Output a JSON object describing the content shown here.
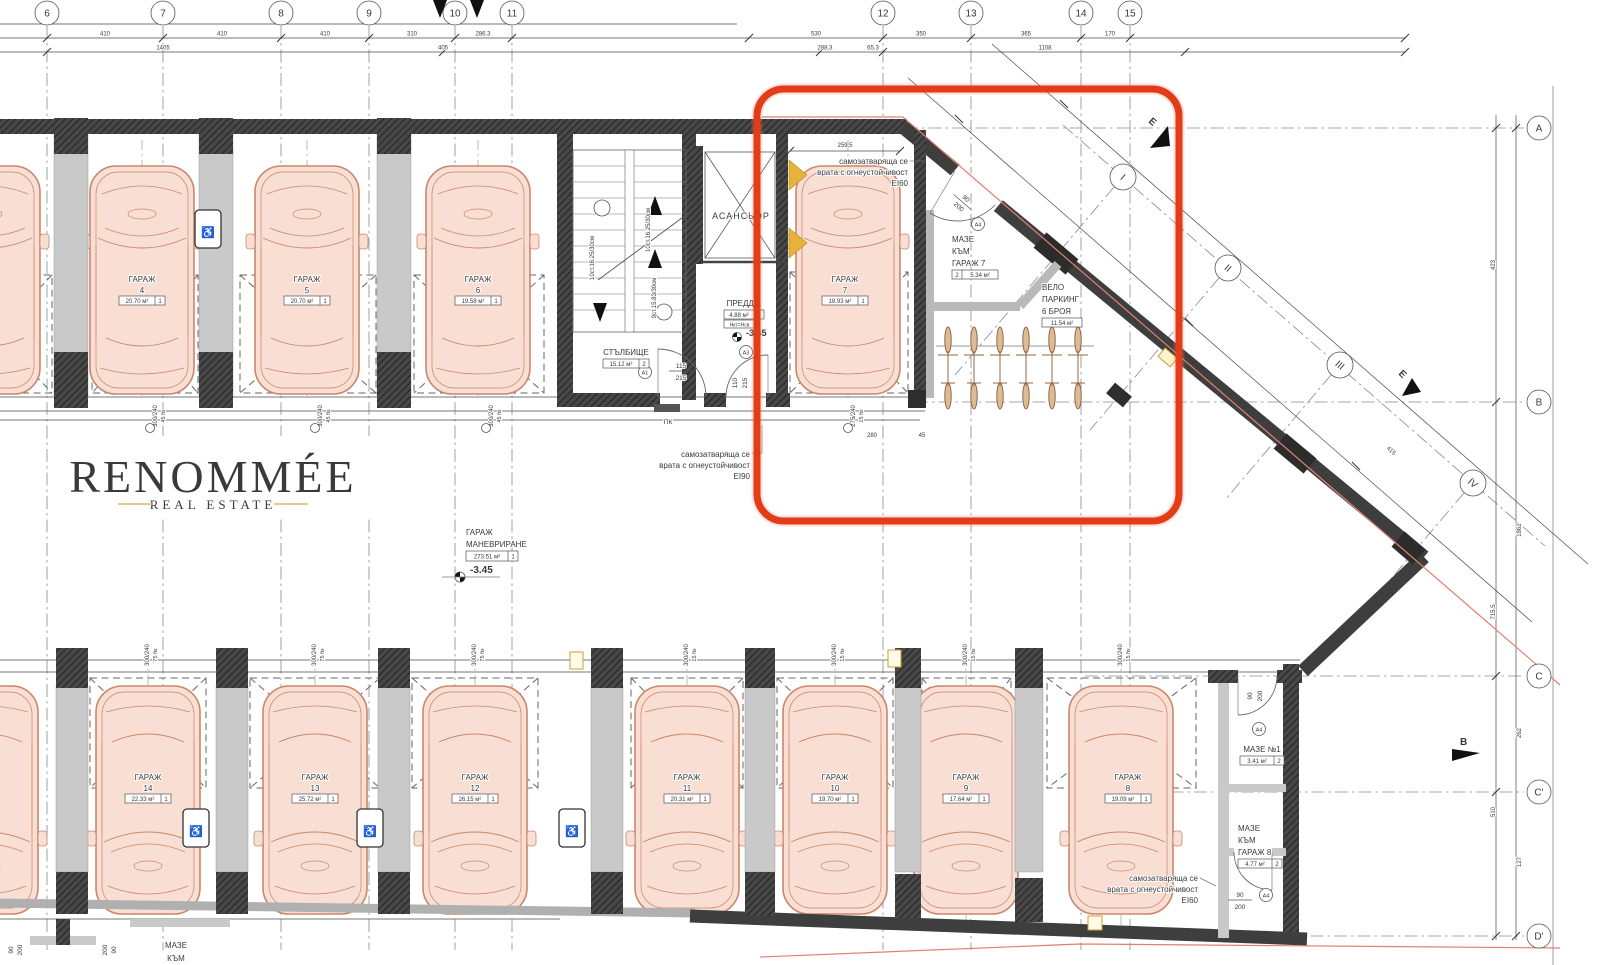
{
  "logo": {
    "title": "RENOMMÉE",
    "subtitle": "REAL ESTATE",
    "gold": "#c9a45a",
    "ink": "#262626"
  },
  "highlight": {
    "color": "#e23c18"
  },
  "grid": {
    "top": [
      "6",
      "7",
      "8",
      "9",
      "10",
      "11",
      "12",
      "13",
      "14",
      "15"
    ],
    "right": [
      "A",
      "B",
      "C",
      "C'",
      "D'"
    ],
    "diag": [
      "I",
      "II",
      "III",
      "IV"
    ],
    "axisE": "E",
    "axisB": "B"
  },
  "garages": {
    "g3": {
      "t": "ГАРАЖ",
      "n": "3",
      "a": "20.70 м²",
      "c": "1"
    },
    "g4": {
      "t": "ГАРАЖ",
      "n": "4",
      "a": "20.70 м²",
      "c": "1"
    },
    "g5": {
      "t": "ГАРАЖ",
      "n": "5",
      "a": "20.70 м²",
      "c": "1"
    },
    "g6": {
      "t": "ГАРАЖ",
      "n": "6",
      "a": "19.58 м²",
      "c": "1"
    },
    "g7": {
      "t": "ГАРАЖ",
      "n": "7",
      "a": "18.93 м²",
      "c": "1"
    },
    "g8": {
      "t": "ГАРАЖ",
      "n": "8",
      "a": "19.09 м²",
      "c": "1"
    },
    "g9": {
      "t": "ГАРАЖ",
      "n": "9",
      "a": "17.64 м²",
      "c": "1"
    },
    "g10": {
      "t": "ГАРАЖ",
      "n": "10",
      "a": "19.70 м²",
      "c": "1"
    },
    "g11": {
      "t": "ГАРАЖ",
      "n": "11",
      "a": "20.31 м²",
      "c": "1"
    },
    "g12": {
      "t": "ГАРАЖ",
      "n": "12",
      "a": "26.15 м²",
      "c": "1"
    },
    "g13": {
      "t": "ГАРАЖ",
      "n": "13",
      "a": "25.72 м²",
      "c": "1"
    },
    "g14": {
      "t": "ГАРАЖ",
      "n": "14",
      "a": "22.33 м²",
      "c": "1"
    }
  },
  "rooms": {
    "elevator": "АСАНСЬОР",
    "stair": {
      "t": "СТЪЛБИЩЕ",
      "a": "15.12 м²",
      "c": "2"
    },
    "vest": {
      "t": "ПРЕДДВ.",
      "a": "4.88 м²",
      "c": "2",
      "h": "Нкт=Нсв"
    },
    "man": {
      "t1": "ГАРАЖ",
      "t2": "МАНЕВРИРАНЕ",
      "a": "273.51 м²",
      "c": "1"
    },
    "maze7": {
      "t1": "МАЗЕ",
      "t2": "КЪМ",
      "t3": "ГАРАЖ 7",
      "a": "5.34 м²",
      "c": "2"
    },
    "velo": {
      "t1": "ВЕЛО",
      "t2": "ПАРКИНГ",
      "t3": "6 БРОЯ",
      "a": "11.54 м²"
    },
    "maze1": {
      "t": "МАЗЕ №1",
      "a": "3.41 м²",
      "c": "2"
    },
    "maze8": {
      "t1": "МАЗЕ",
      "t2": "КЪМ",
      "t3": "ГАРАЖ 8",
      "a": "4.77 м²",
      "c": "2"
    },
    "mazebl": {
      "t1": "МАЗЕ",
      "t2": "КЪМ"
    },
    "pk": "ПК"
  },
  "notes": {
    "l1": "самозатваряща се",
    "l2": "врата с огнеустойчивост",
    "ei60": "EI60",
    "ei90": "EI90"
  },
  "stairs": {
    "r1": "10ст.16.25/30см",
    "r2": "10ст.16.25/30см",
    "r3": "9ст.15.83/30см"
  },
  "levels": {
    "v": "-3.45"
  },
  "doors": {
    "a1": "А1",
    "a3": "А3",
    "a4": "А4",
    "w115": "115",
    "h215": "215",
    "w110": "110",
    "w90": "90",
    "h200": "200"
  },
  "dims": {
    "total": "4727",
    "r1": [
      "410",
      "410",
      "410",
      "310",
      "286.3",
      "530",
      "350",
      "365",
      "170"
    ],
    "r2": [
      "1405",
      "405",
      "288.3",
      "65.3",
      "1108"
    ],
    "right": [
      "423",
      "715.5",
      "510",
      "1862",
      "262",
      "127"
    ],
    "diag": [
      "259.5",
      "415"
    ],
    "strip": {
      "t1": "300/240",
      "t2": "275/240",
      "f45": "45 fix",
      "f75": "75 fix",
      "f15": "15 fix",
      "w280": "280",
      "n45": "45"
    }
  },
  "icons": {
    "handicap": "♿"
  }
}
